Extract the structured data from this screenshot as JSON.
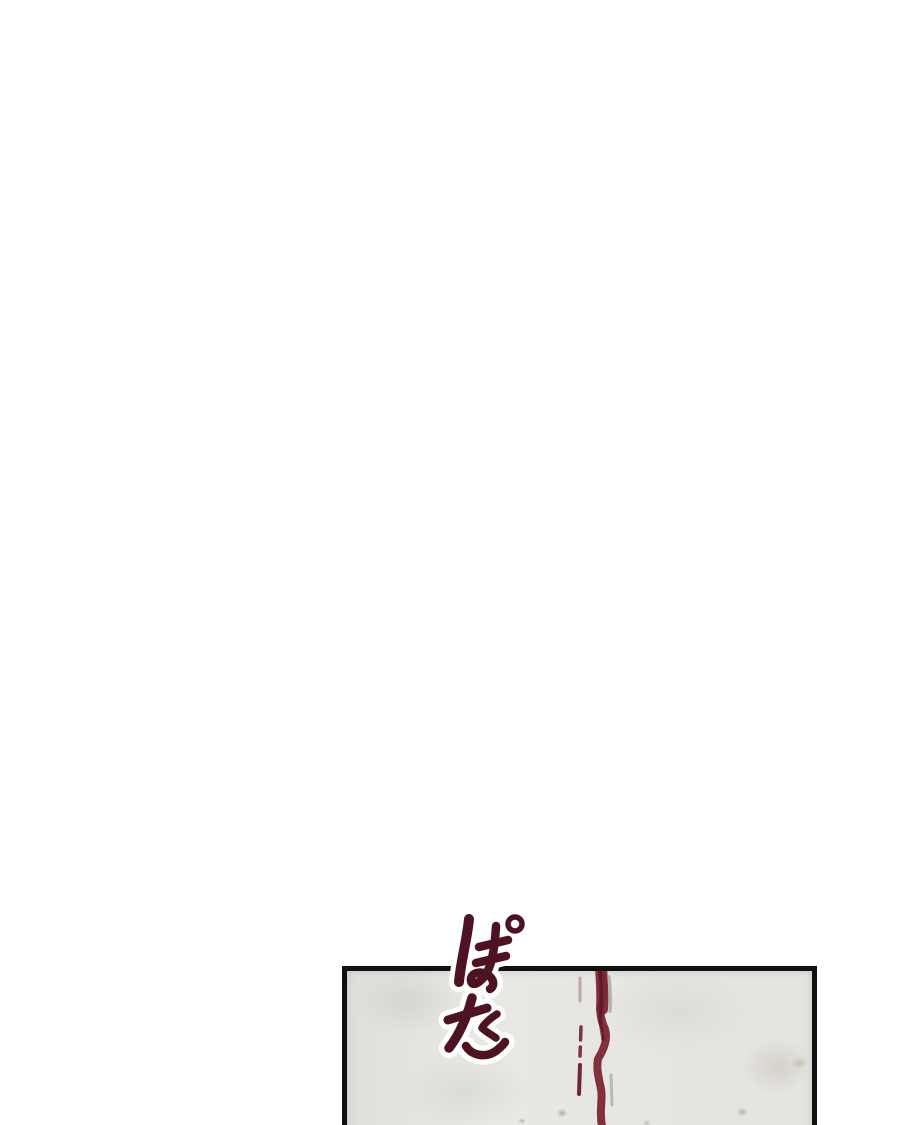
{
  "page": {
    "background_color": "#ffffff",
    "description_text": ""
  },
  "panel": {
    "border_color": "#101010",
    "background_color": "#e9e8e5",
    "sfx": {
      "text": "ぽた",
      "color": "#4e1322",
      "outline_color": "#ffffff"
    },
    "blood_drip": {
      "main_color": "#7b2634",
      "dark_core_color": "#571624",
      "shadow_streak_color": "#a5a5a2",
      "side_drip_colors": [
        "#b3999d",
        "#7c3440",
        "#6d2835"
      ]
    }
  }
}
